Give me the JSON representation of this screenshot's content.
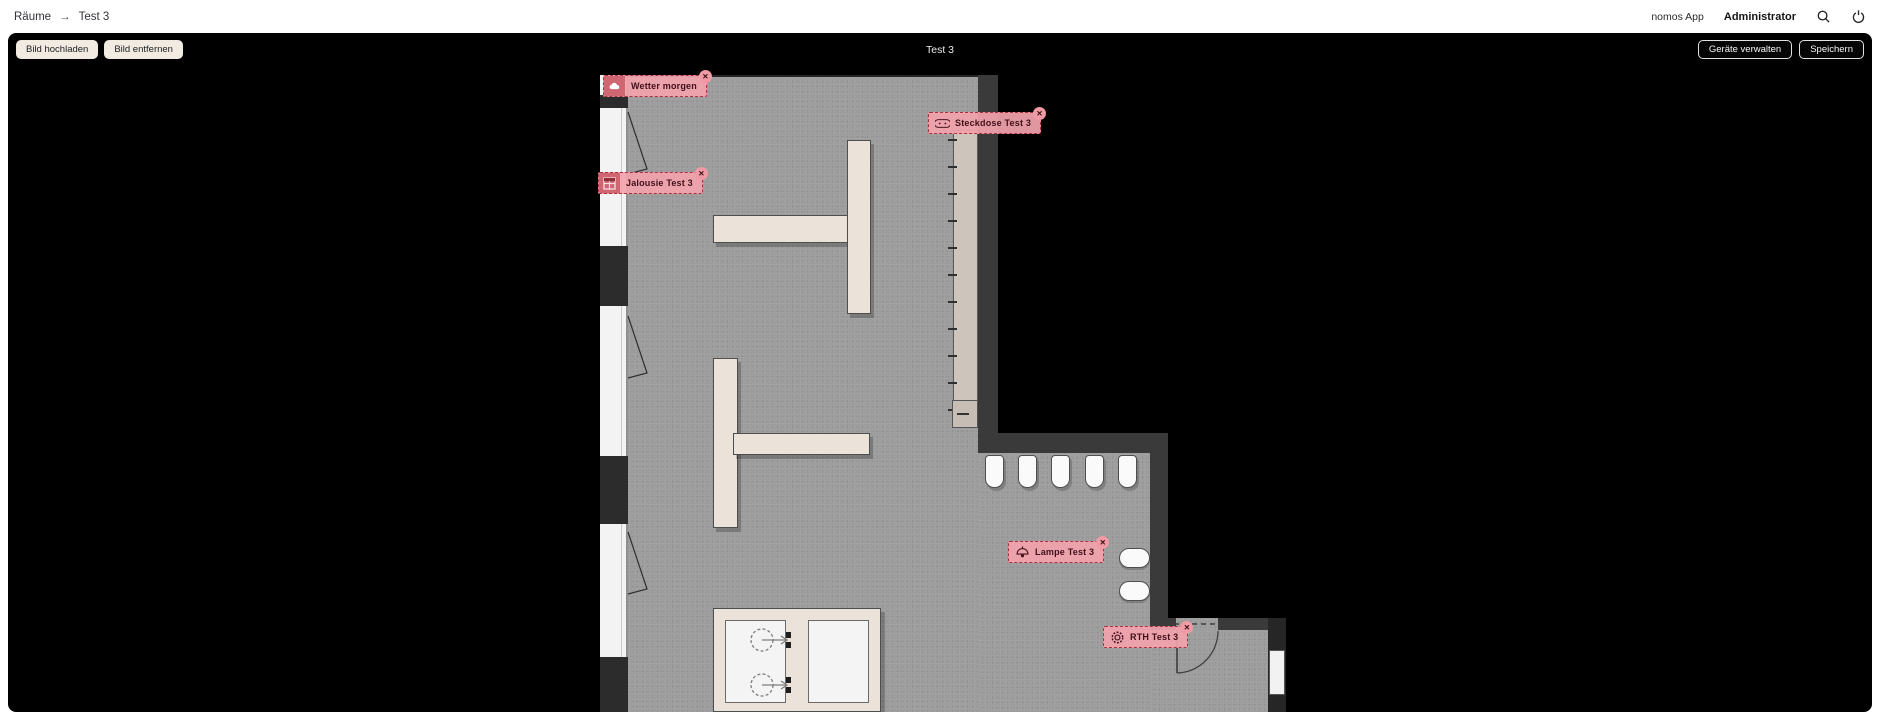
{
  "header": {
    "breadcrumb": {
      "root": "Räume",
      "separator": "→",
      "current": "Test 3"
    },
    "app_name": "nomos App",
    "user_name": "Administrator",
    "icons": {
      "search": "search-icon",
      "power": "power-icon"
    }
  },
  "toolbar": {
    "upload_image": "Bild hochladen",
    "remove_image": "Bild entfernen",
    "room_title": "Test 3",
    "manage_devices": "Geräte verwalten",
    "save": "Speichern"
  },
  "floorplan": {
    "close_glyph": "✕",
    "tags": [
      {
        "id": "weather",
        "label": "Wetter morgen",
        "icon": "cloud-icon",
        "variant": "solid",
        "left": 3,
        "top": 3
      },
      {
        "id": "socket",
        "label": "Steckdose Test 3",
        "icon": "socket-icon",
        "variant": "outline",
        "left": 328,
        "top": 40
      },
      {
        "id": "blinds",
        "label": "Jalousie Test 3",
        "icon": "blinds-icon",
        "variant": "solid",
        "left": -2,
        "top": 100
      },
      {
        "id": "lamp",
        "label": "Lampe Test 3",
        "icon": "lamp-icon",
        "variant": "outline",
        "left": 408,
        "top": 469
      },
      {
        "id": "thermostat",
        "label": "RTH Test 3",
        "icon": "thermostat-icon",
        "variant": "outline",
        "left": 503,
        "top": 554
      }
    ]
  },
  "colors": {
    "canvas": "#000000",
    "floor": "#9c9c9c",
    "wall": "#3a3a3a",
    "tag_bg": "#f2a3ab",
    "tag_border": "#a83240",
    "tag_text": "#3f1019",
    "button_cream": "#f1ebe2"
  }
}
